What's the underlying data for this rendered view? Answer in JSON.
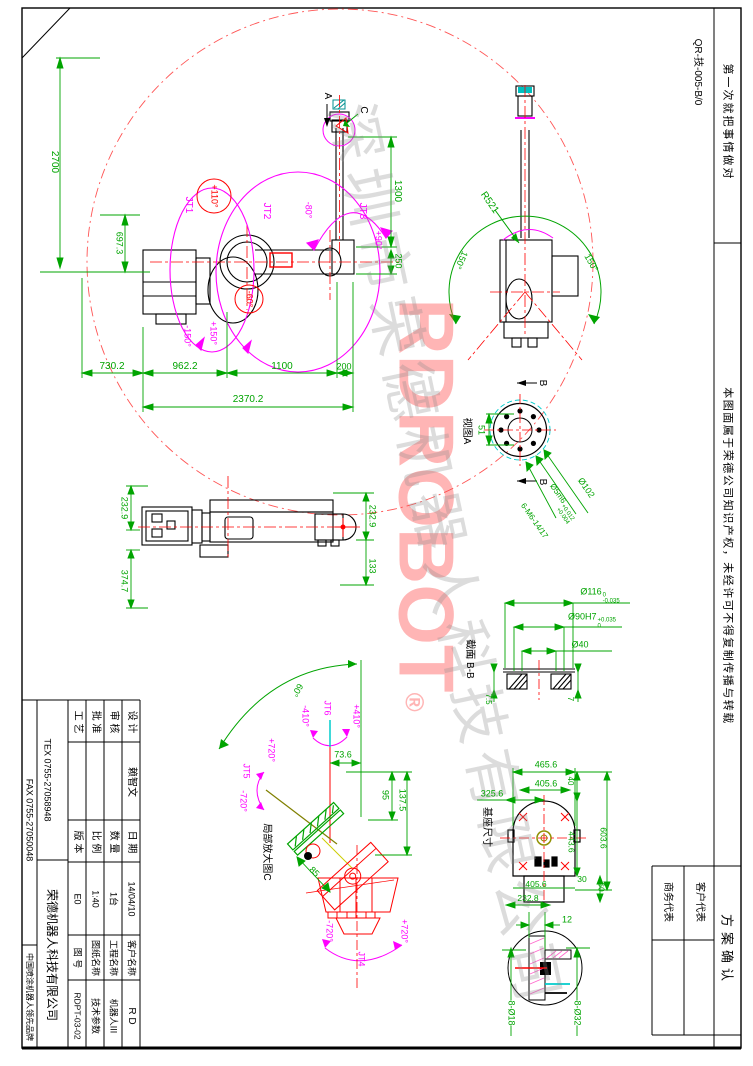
{
  "page": {
    "doc_no": "QR-技-005-B/0",
    "slogan": "第一次就把事情做对",
    "ip_notice": "本图面属于荣德公司知识产权，未经许可不得复制传播与转载"
  },
  "approval": {
    "title": "方案确认",
    "customer": "客户代表",
    "business": "商务代表"
  },
  "title_block": {
    "design_label": "设 计",
    "designer": "赖智文",
    "date_label": "日 期",
    "date": "14/04/10",
    "client_label": "客户名称",
    "client": "R D",
    "audit_label": "审 核",
    "qty_label": "数 量",
    "qty": "1台",
    "project_label": "工程名称",
    "project": "机器人III",
    "approve_label": "批 准",
    "scale_label": "比 例",
    "scale": "1:40",
    "sheetname_label": "图纸名称",
    "sheetname": "技术参数",
    "process_label": "工 艺",
    "version_label": "版 本",
    "version": "E0",
    "number_label": "图 号",
    "number": "RDPT-03-02",
    "tex": "TEX 0755-27058948",
    "fax": "FAX 0755-27050048",
    "company": "荣德机器人科技有限公司",
    "tagline": "中国喷涂机器人领先品牌"
  },
  "front_view": {
    "jt1": "JT1",
    "jt2": "JT2",
    "jt3": "JT3",
    "jt1_max": "+110°",
    "jt2_min": "-60°",
    "jt3_min": "-80°",
    "jt3_max": "+90°",
    "swing_pos": "+150°",
    "swing_neg": "-150°",
    "reach": "2700",
    "shoulder": "697.3",
    "arm": "1300",
    "offset": "250",
    "d1": "730.2",
    "d2": "962.2",
    "d3": "1100",
    "d4": "200",
    "total": "2370.2",
    "sec_a": "A",
    "det_c": "C"
  },
  "rear_view": {
    "radius": "R521",
    "left": "150°",
    "right": "150°"
  },
  "view_a": {
    "title": "视图A",
    "dim": "51",
    "b": "B",
    "phi102": "Ø102",
    "pin": "Ø5m6",
    "p_sup": "+0.012",
    "p_sub": "+0.004",
    "holes": "6-M6-14/17"
  },
  "section_bb": {
    "title": "截面 B-B",
    "d116": "Ø116",
    "d116_sup": "0",
    "d116_sub": "-0.035",
    "d90": "Ø90H7",
    "d90_sup": "+0.035",
    "d90_sub": "0",
    "d40": "Ø40",
    "t_left": "7.5",
    "t_right": "7"
  },
  "side_view": {
    "w1": "232.9",
    "l1": "374.7",
    "w2": "232.9",
    "off": "133"
  },
  "detail_c": {
    "title": "局部放大图C",
    "jt4": "JT4",
    "jt5": "JT5",
    "jt6": "JT6",
    "jt6_min": "-410°",
    "jt6_max": "+410°",
    "jt5_max": "+720°",
    "jt5_min": "-720°",
    "jt4_min": "-720°",
    "jt4_max": "+720°",
    "angle": "60°",
    "d1": "73.6",
    "d2": "95",
    "d3": "137.5",
    "d4": "85"
  },
  "base_view": {
    "title": "基座尺寸",
    "w1": "465.6",
    "w2": "405.6",
    "w3": "325.6",
    "d40": "40",
    "h1": "443.6",
    "h2": "603.6",
    "w4": "405.6",
    "d30": "30",
    "d60": "60",
    "w5": "232.8"
  },
  "bolt_detail": {
    "d12": "12",
    "h18": "8-Ø18",
    "h32": "8-Ø32"
  },
  "watermark": {
    "brand": "RDROBOT",
    "reg": "®",
    "company": "深圳市荣德机器人科技有限公司"
  },
  "colors": {
    "dim": "#00a400",
    "joint": "#ff00ff",
    "limit": "#ff0000",
    "accent": "#00cccc",
    "brand": "#ff4646"
  }
}
